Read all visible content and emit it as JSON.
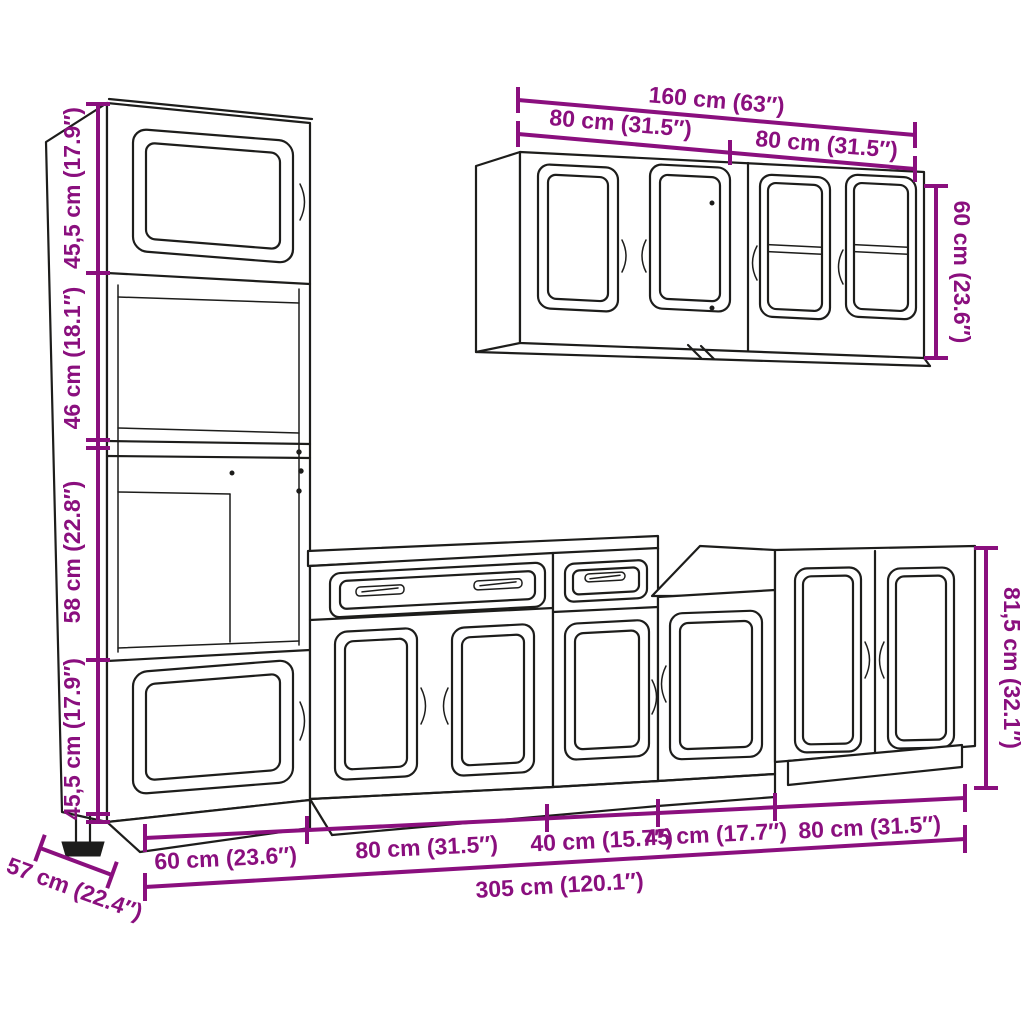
{
  "colors": {
    "background": "#ffffff",
    "line": "#1d1d1b",
    "dimension": "#8a0f7e"
  },
  "dims": {
    "tall_sections": [
      "45,5 cm (17.9″)",
      "46 cm (18.1″)",
      "58 cm (22.8″)",
      "45,5 cm (17.9″)"
    ],
    "wall_total": "160 cm (63″)",
    "wall_left": "80 cm (31.5″)",
    "wall_right": "80 cm (31.5″)",
    "wall_height": "60 cm (23.6″)",
    "base_height": "81,5 cm (32.1″)",
    "base_segments": [
      "60 cm (23.6″)",
      "80 cm (31.5″)",
      "40 cm (15.7″)",
      "45 cm (17.7″)",
      "80 cm (31.5″)"
    ],
    "base_total": "305 cm (120.1″)",
    "depth": "57 cm (22.4″)"
  }
}
